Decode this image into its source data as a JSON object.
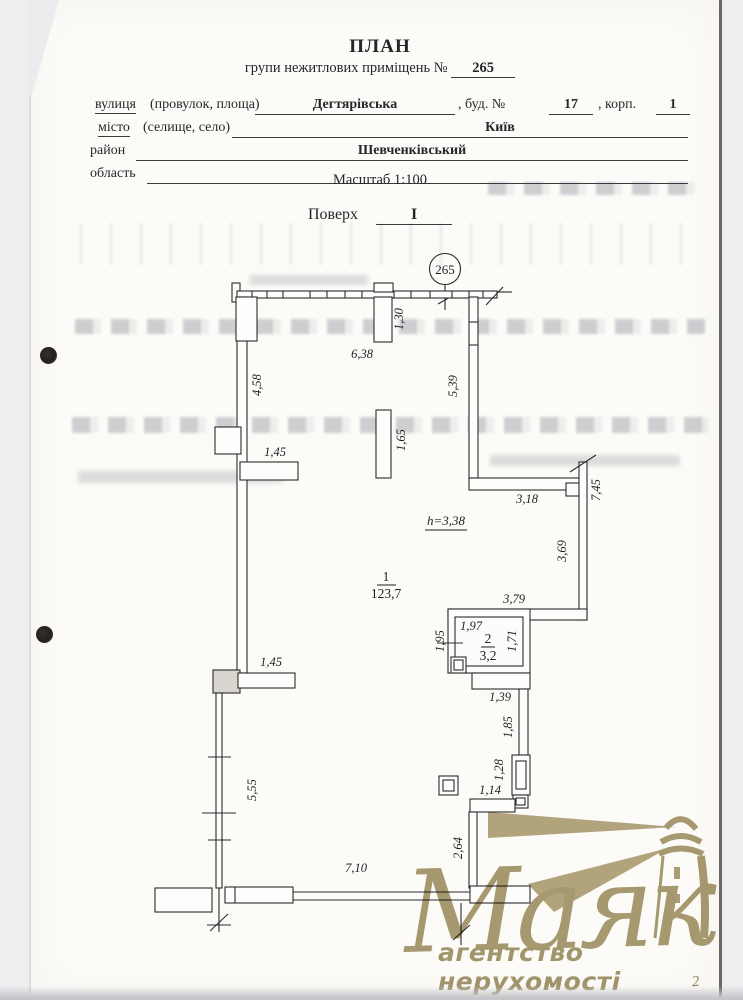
{
  "page": {
    "title": "ПЛАН",
    "subtitle_prefix": "групи нежитлових приміщень №",
    "unit_number": "265",
    "scale_label": "Масштаб 1:100",
    "floor_label": "Поверх",
    "floor_value": "I",
    "handwritten_mark": "2"
  },
  "address_form": {
    "row1": {
      "label": "вулиця",
      "sublabel": "(провулок, площа)",
      "value": "Дегтярівська",
      "bud_label": ",   буд. №",
      "bud_value": "17",
      "korp_label": ",   корп.",
      "korp_value": "1"
    },
    "row2": {
      "label": "місто",
      "sublabel": "(селище, село)",
      "value": "Київ"
    },
    "row3": {
      "label": "район",
      "value": "Шевченківський"
    },
    "row4": {
      "label": "область",
      "value": ""
    }
  },
  "plan": {
    "unit_circle": "265",
    "room1": {
      "number": "1",
      "area": "123,7"
    },
    "room2": {
      "number": "2",
      "area": "3,2"
    },
    "dims": {
      "top_opening": "1,30",
      "top_width": "6,38",
      "left_upper": "4,58",
      "right_upper": "5,39",
      "partition_upper": "1,45",
      "pillar_center": "1,65",
      "step_width": "3,18",
      "right_outer": "7,45",
      "ceiling_height": "h=3,38",
      "right_inner": "3,69",
      "ledge_width": "3,79",
      "room2_width": "1,97",
      "room2_door": "1,95",
      "room2_depth": "1,71",
      "partition_lower": "1,45",
      "passage_width": "1,39",
      "passage_depth": "1,85",
      "door_lower": "1,28",
      "niche_width": "1,14",
      "left_lower": "5,55",
      "wall_lower": "2,64",
      "bottom_width": "7,10"
    }
  },
  "watermark": {
    "brand": "Маяк",
    "tagline": "агентство нерухомості",
    "color": "#a89b72"
  }
}
